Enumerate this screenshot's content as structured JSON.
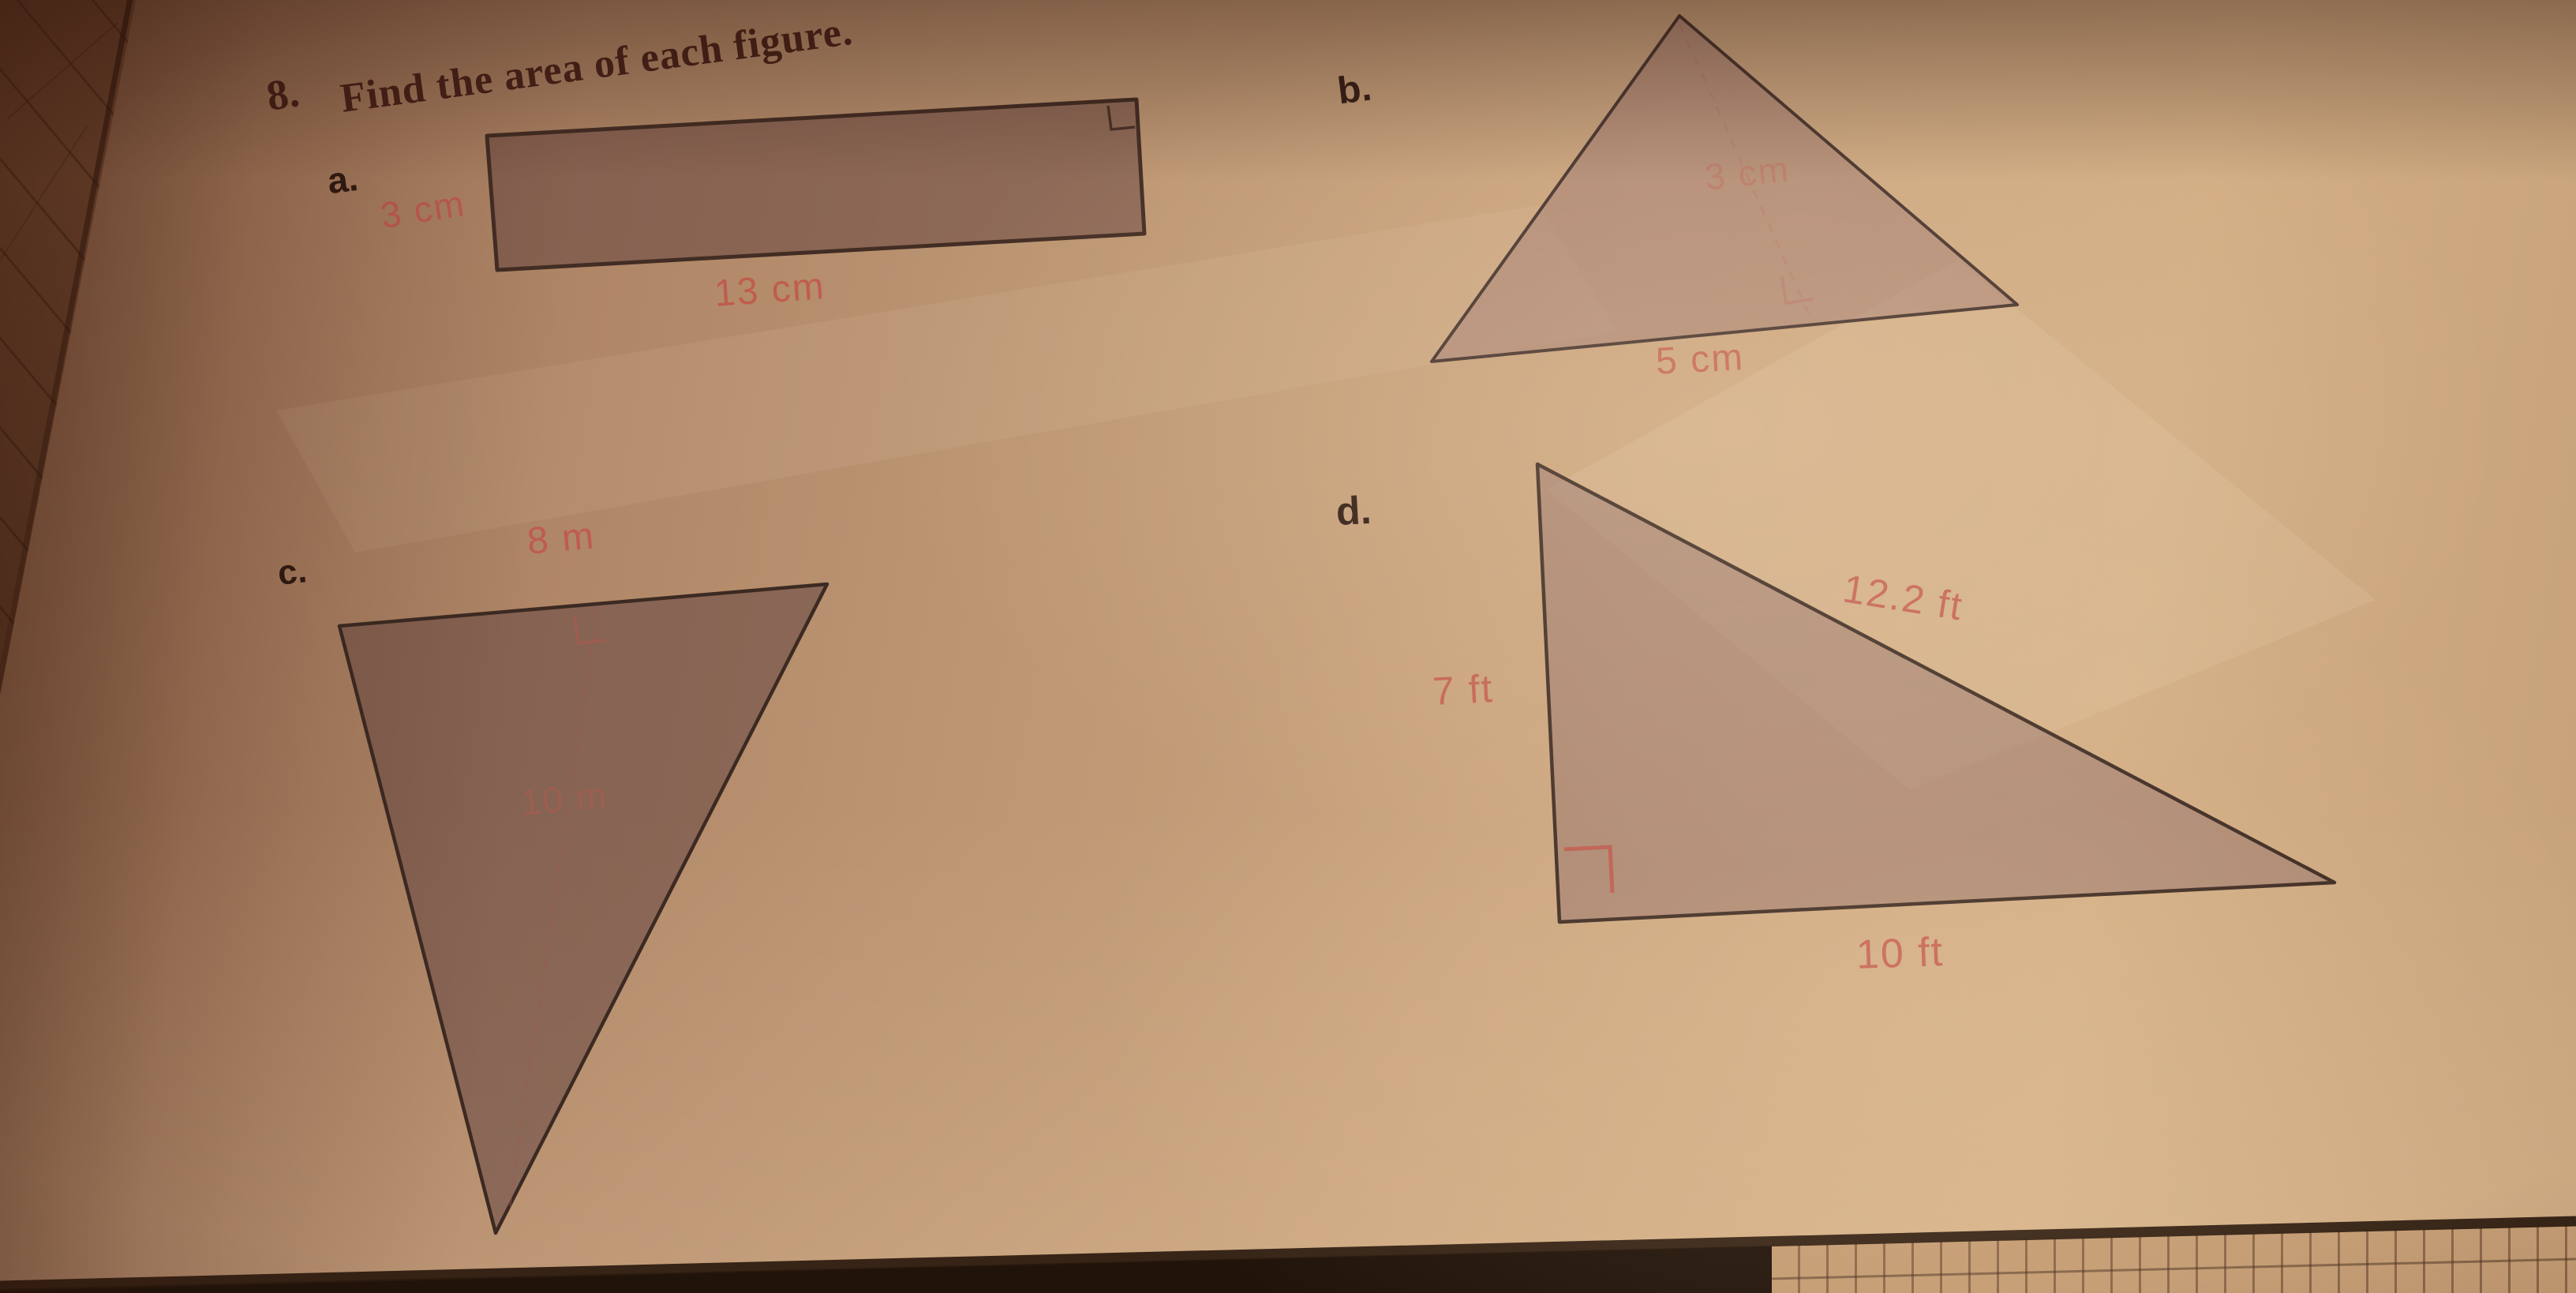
{
  "colors": {
    "paper": "#c09873",
    "ink_dark": "#3a241a",
    "title_ink": "#48221a",
    "accent_red": "#c2554b",
    "shape_fill_mauve": "#8f6b66",
    "page_edge_dark": "#2a1810",
    "grid_paper": "#c49c74"
  },
  "problem": {
    "number": "8.",
    "title": "Find the area of each figure."
  },
  "figures": [
    {
      "letter": "a.",
      "shape": "rectangle",
      "labels": {
        "height": "3 cm",
        "base": "13 cm"
      },
      "has_right_angle_marker": true
    },
    {
      "letter": "b.",
      "shape": "triangle",
      "labels": {
        "height": "3 cm",
        "base": "5 cm"
      },
      "has_right_angle_marker": true
    },
    {
      "letter": "c.",
      "shape": "triangle",
      "labels": {
        "base": "8 m",
        "height": "10 m"
      },
      "has_right_angle_marker": true
    },
    {
      "letter": "d.",
      "shape": "right-triangle",
      "labels": {
        "leg": "7 ft",
        "hypotenuse": "12.2 ft",
        "base": "10 ft"
      },
      "has_right_angle_marker": true
    }
  ]
}
